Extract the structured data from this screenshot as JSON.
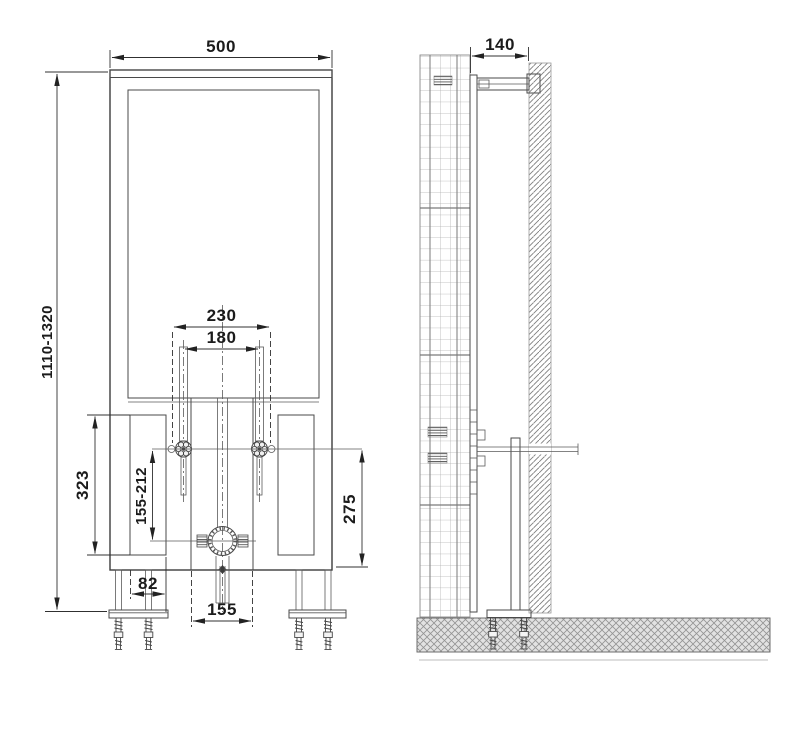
{
  "drawing_title": "concealed-cistern-installation-frame-dimensional-drawing",
  "front_view": {
    "dim_frame_width": "500",
    "dim_frame_height_range": "1110-1320",
    "dim_anchor_spacing_outer": "230",
    "dim_rod_spacing": "180",
    "dim_side_panel_height": "323",
    "dim_rod_to_outlet_range": "155-212",
    "dim_rod_to_base": "275",
    "dim_side_panel_width": "82",
    "dim_outlet_opening_width": "155"
  },
  "side_view": {
    "dim_frame_depth": "140"
  }
}
